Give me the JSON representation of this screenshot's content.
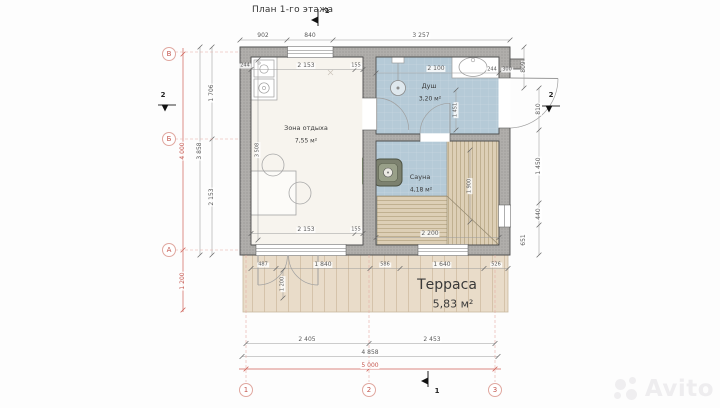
{
  "title": "План 1-го этажа",
  "watermark": "Avito",
  "rooms": [
    {
      "name": "Зона отдыха",
      "area": "7,55 м²"
    },
    {
      "name": "Душ",
      "area": "3,20 м²"
    },
    {
      "name": "Сауна",
      "area": "4,18 м²"
    },
    {
      "name": "Терраса",
      "area": "5,83 м²"
    }
  ],
  "axis_markers": [
    {
      "label": "В"
    },
    {
      "label": "Б"
    },
    {
      "label": "А"
    },
    {
      "label": "1"
    },
    {
      "label": "2"
    },
    {
      "label": "3"
    }
  ],
  "section_markers": [
    {
      "label": "1"
    },
    {
      "label": "2"
    },
    {
      "label": "2"
    },
    {
      "label": "1"
    }
  ],
  "overall_dimensions": {
    "total_width": "5 000",
    "building_width": "4 858",
    "total_depth": "4 000",
    "building_depth": "3 858",
    "terrace_depth": "1 200"
  },
  "colors": {
    "axis_red": "#c4564e",
    "wall_gray": "#b0aeab",
    "wet_floor_blue": "#b5cad7",
    "bench_wood": "#ddcfb6",
    "terrace_wood": "#e9dcc9",
    "rest_floor": "#f7f4ee"
  },
  "dimension_labels": [
    {
      "text": "902",
      "x": 263,
      "y": 36
    },
    {
      "text": "840",
      "x": 310,
      "y": 36
    },
    {
      "text": "3 257",
      "x": 421,
      "y": 36
    },
    {
      "text": "244",
      "x": 245,
      "y": 66,
      "size": 5
    },
    {
      "text": "2 153",
      "x": 306,
      "y": 66
    },
    {
      "text": "155",
      "x": 356,
      "y": 66,
      "size": 5
    },
    {
      "text": "2 100",
      "x": 436,
      "y": 69
    },
    {
      "text": "244",
      "x": 492,
      "y": 70,
      "size": 5
    },
    {
      "text": "300",
      "x": 507,
      "y": 70,
      "size": 5
    },
    {
      "text": "809",
      "x": 524,
      "y": 67,
      "rot": true
    },
    {
      "text": "810",
      "x": 539,
      "y": 109,
      "rot": true
    },
    {
      "text": "1 450",
      "x": 539,
      "y": 166,
      "rot": true
    },
    {
      "text": "440",
      "x": 539,
      "y": 214,
      "rot": true
    },
    {
      "text": "651",
      "x": 524,
      "y": 240,
      "rot": true
    },
    {
      "text": "4 000",
      "x": 183,
      "y": 151,
      "rot": true,
      "red": true
    },
    {
      "text": "3 858",
      "x": 200,
      "y": 151,
      "rot": true
    },
    {
      "text": "1 706",
      "x": 212,
      "y": 93,
      "rot": true
    },
    {
      "text": "2 153",
      "x": 212,
      "y": 197,
      "rot": true
    },
    {
      "text": "1 200",
      "x": 183,
      "y": 281,
      "rot": true,
      "red": true
    },
    {
      "text": "3 508",
      "x": 258,
      "y": 150,
      "rot": true,
      "size": 5
    },
    {
      "text": "2 153",
      "x": 306,
      "y": 230
    },
    {
      "text": "155",
      "x": 356,
      "y": 230,
      "size": 5
    },
    {
      "text": "2 200",
      "x": 430,
      "y": 234
    },
    {
      "text": "1 900",
      "x": 470,
      "y": 186,
      "rot": true,
      "size": 5
    },
    {
      "text": "1 451",
      "x": 456,
      "y": 110,
      "rot": true,
      "size": 5
    },
    {
      "text": "1 200",
      "x": 283,
      "y": 284,
      "rot": true,
      "size": 5
    },
    {
      "text": "487",
      "x": 263,
      "y": 265,
      "size": 5
    },
    {
      "text": "1 840",
      "x": 323,
      "y": 265
    },
    {
      "text": "586",
      "x": 385,
      "y": 265,
      "size": 5
    },
    {
      "text": "1 640",
      "x": 442,
      "y": 265
    },
    {
      "text": "526",
      "x": 496,
      "y": 265,
      "size": 5
    },
    {
      "text": "2 405",
      "x": 307,
      "y": 340
    },
    {
      "text": "2 453",
      "x": 432,
      "y": 340
    },
    {
      "text": "4 858",
      "x": 370,
      "y": 353
    },
    {
      "text": "5 000",
      "x": 370,
      "y": 366,
      "red": true
    }
  ]
}
